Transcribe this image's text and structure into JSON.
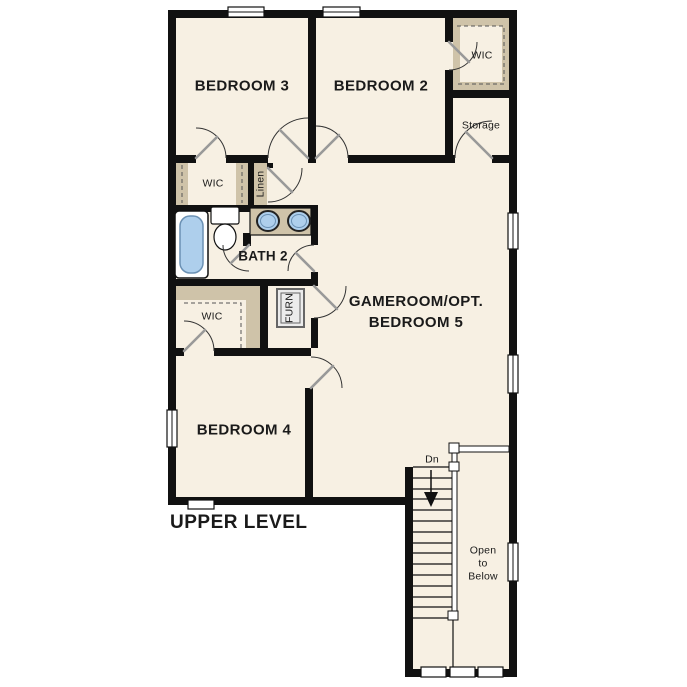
{
  "title": "UPPER LEVEL",
  "colors": {
    "wall": "#111111",
    "floor": "#f7f0e3",
    "shelf": "#cfc3a9",
    "fixture": "#aecfec",
    "fixture-edge": "#6b91b4",
    "door-leaf": "#999999",
    "arc": "#333333",
    "text": "#1a1a1a"
  },
  "rooms": {
    "bedroom3": "BEDROOM 3",
    "bedroom2": "BEDROOM 2",
    "bedroom4": "BEDROOM 4",
    "gameroom": "GAMEROOM/OPT.\nBEDROOM 5",
    "bath2": "BATH 2",
    "wic_top_right": "WIC",
    "wic_left": "WIC",
    "wic_mid": "WIC",
    "linen": "Linen",
    "storage": "Storage",
    "furn": "FURN",
    "stairs_dn": "Dn",
    "open_to_below": "Open\nto\nBelow"
  }
}
